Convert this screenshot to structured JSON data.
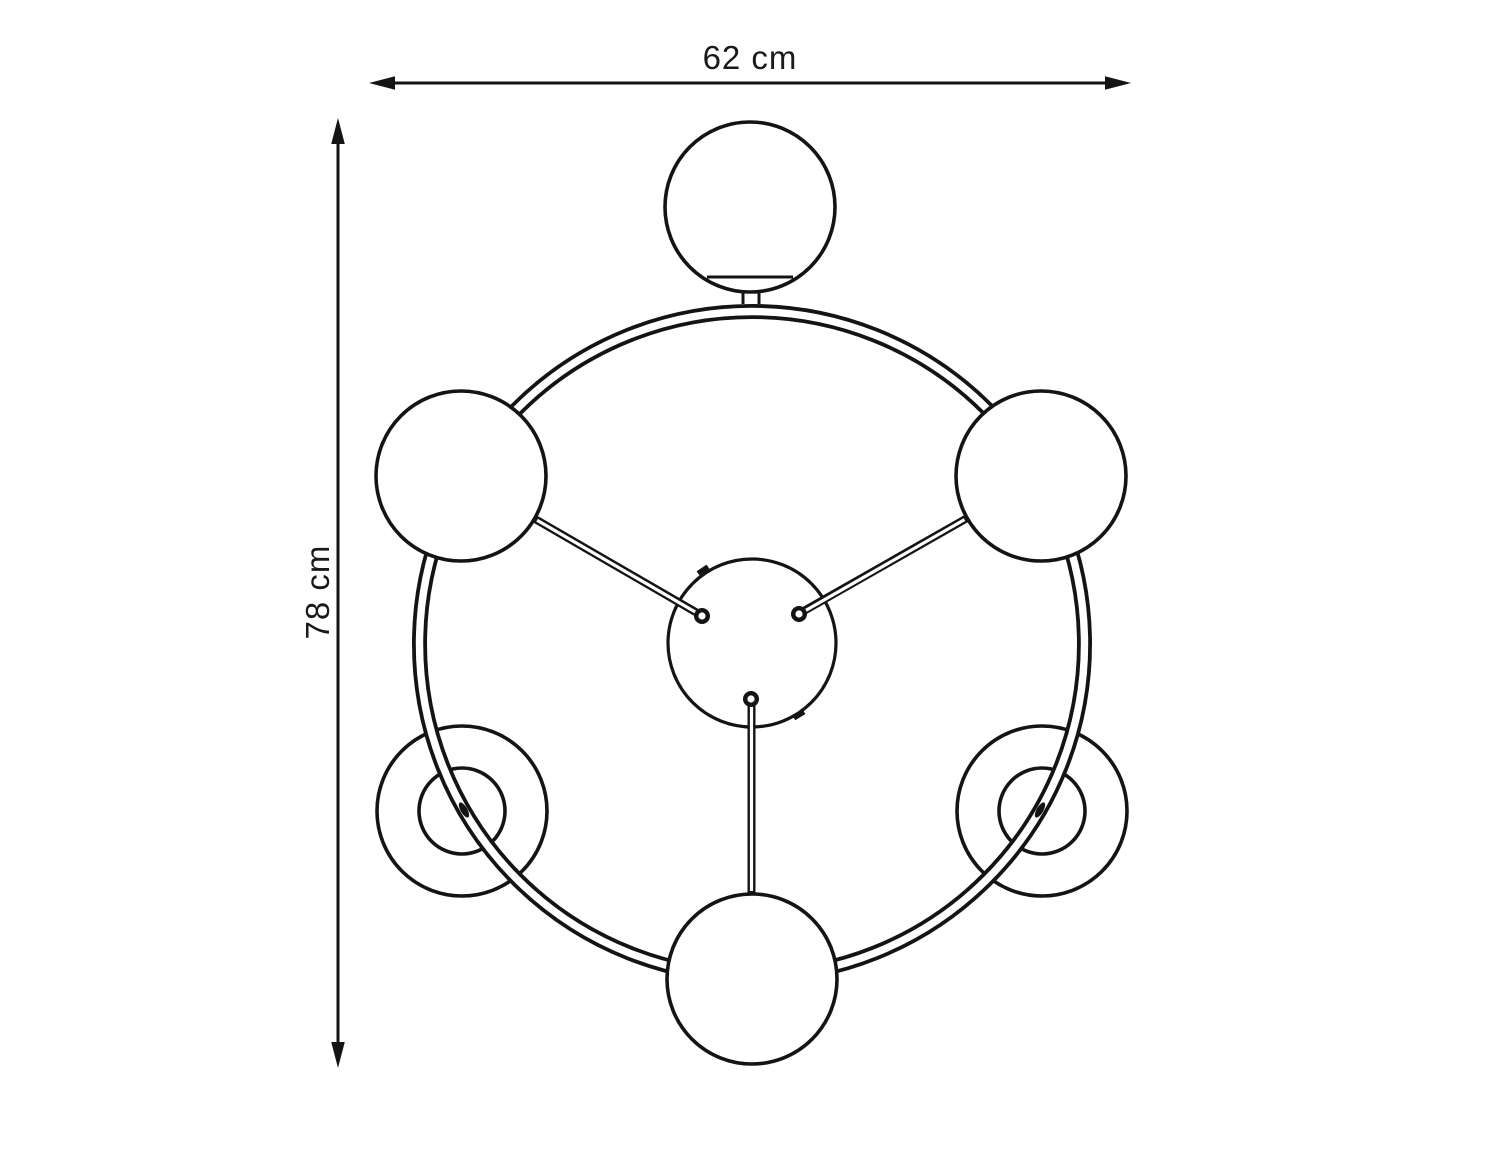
{
  "canvas": {
    "background": "#ffffff",
    "line_color": "#141414"
  },
  "dimension_labels": {
    "width": "62 cm",
    "height": "78 cm"
  }
}
